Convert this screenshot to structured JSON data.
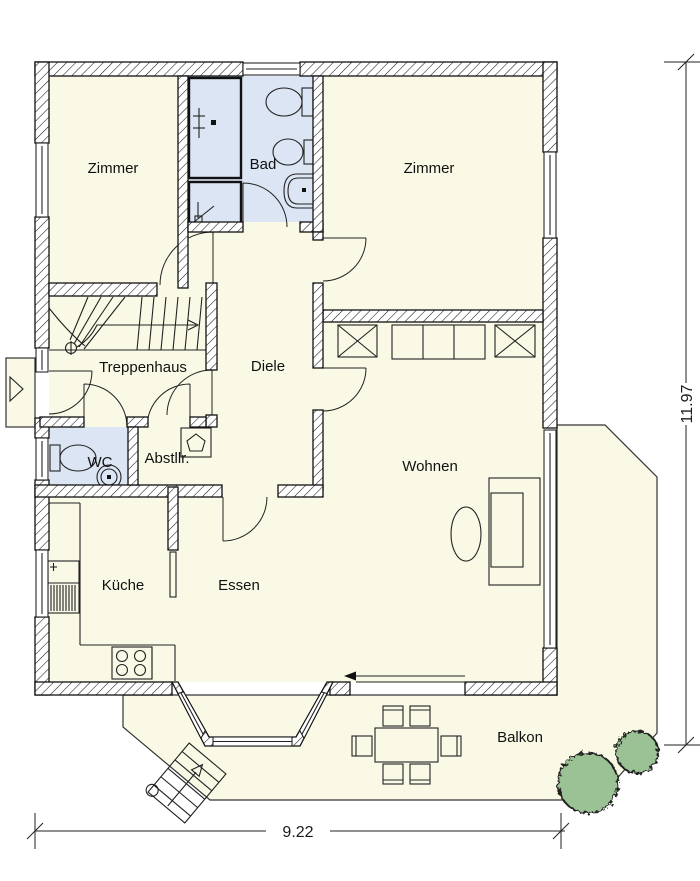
{
  "rooms": {
    "zimmer_left": {
      "label": "Zimmer"
    },
    "bad": {
      "label": "Bad"
    },
    "zimmer_right": {
      "label": "Zimmer"
    },
    "treppenhaus": {
      "label": "Treppenhaus"
    },
    "diele": {
      "label": "Diele"
    },
    "wc": {
      "label": "WC"
    },
    "abstellraum": {
      "label": "Abstllr."
    },
    "wohnen": {
      "label": "Wohnen"
    },
    "kueche": {
      "label": "Küche"
    },
    "essen": {
      "label": "Essen"
    },
    "balkon": {
      "label": "Balkon"
    }
  },
  "dimensions": {
    "width_label": "9.22",
    "height_label": "11.97"
  },
  "colors": {
    "floor": "#faf9e6",
    "wet_room": "#dbe5f3",
    "tree": "#9bc295",
    "wall_line": "#111111",
    "background": "#ffffff"
  }
}
